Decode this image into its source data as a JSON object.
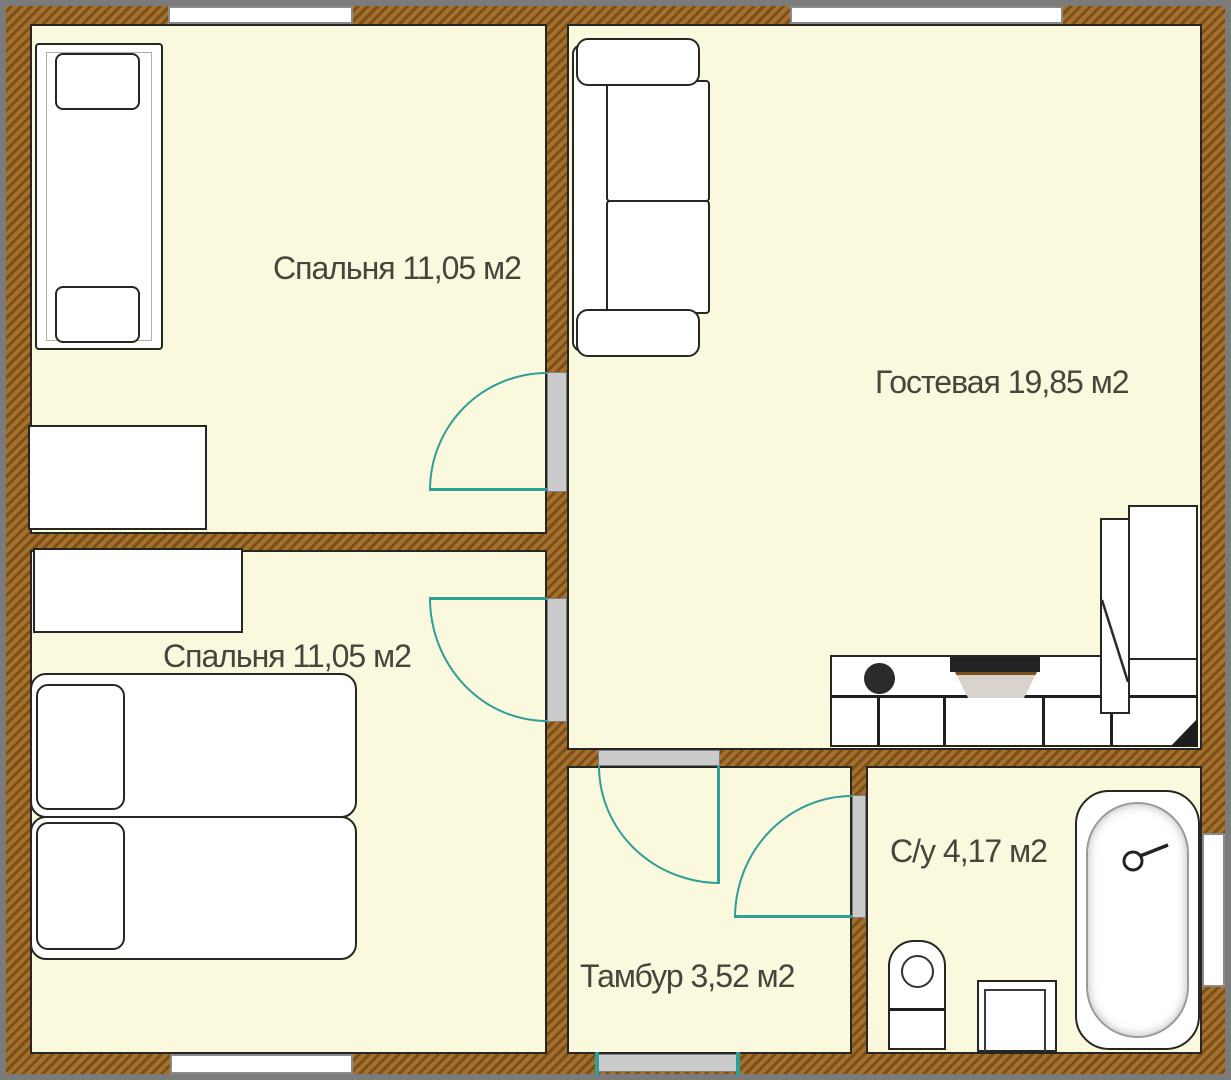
{
  "plan": {
    "title": "Apartment floor plan",
    "rooms": [
      {
        "id": "bedroom-top",
        "label": "Спальня 11,05 м2"
      },
      {
        "id": "guest-room",
        "label": "Гостевая 19,85 м2"
      },
      {
        "id": "bedroom-bottom",
        "label": "Спальня 11,05 м2"
      },
      {
        "id": "vestibule",
        "label": "Тамбур 3,52 м2"
      },
      {
        "id": "bathroom",
        "label": "С/у 4,17 м2"
      }
    ],
    "colors": {
      "wallBase": "#a5702c",
      "wallHatch": "#7a4f1a",
      "roomFill": "#faf8dd",
      "doorSwing": "#2f9e96",
      "doorLeaf": "#cbcbcb",
      "outline": "#262622",
      "frameGray": "#7b7b7b",
      "labelColor": "#45453b"
    }
  }
}
